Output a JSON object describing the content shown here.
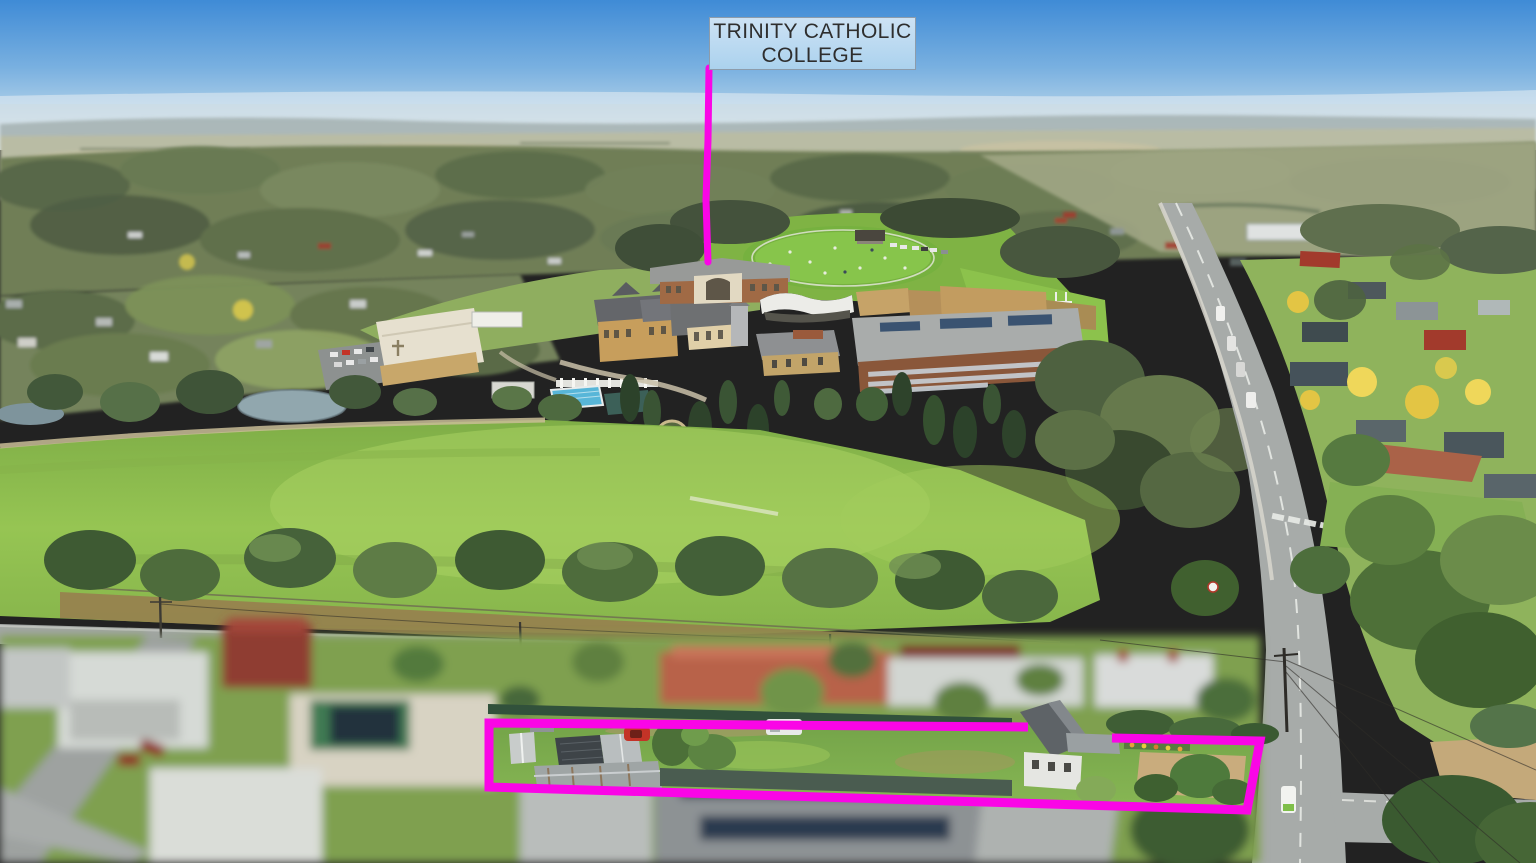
{
  "photo": {
    "kind": "aerial drone photograph",
    "caption": "Aerial view of a residential property outlined in magenta, with a school campus, oval and playing fields beyond",
    "width_px": 1536,
    "height_px": 863
  },
  "annotations": {
    "school_label": {
      "line1": "TRINITY CATHOLIC",
      "line2": "COLLEGE"
    },
    "leader_line": "vertical magenta line from label down to the college buildings",
    "property_outline": "magenta boundary outline around the subject property in the foreground"
  },
  "theme": {
    "highlight": "#fa05e6",
    "label-bg-top": "#cde2f4",
    "label-bg-bottom": "#abd2ee",
    "label-border": "#8d9cab",
    "label-text": "#2e2e2e",
    "sky-top": "#3f8bd6",
    "sky-horizon": "#e2eaee",
    "field-green": "#8fbf4f",
    "road-gray": "#a7aba9"
  },
  "scene_elements": [
    "sky",
    "distant hills",
    "tree-covered suburb",
    "school campus buildings",
    "school oval",
    "swimming pool",
    "playing fields",
    "main road",
    "residential street",
    "blurred neighbouring houses",
    "subject property with sheds, cars and cottage"
  ]
}
